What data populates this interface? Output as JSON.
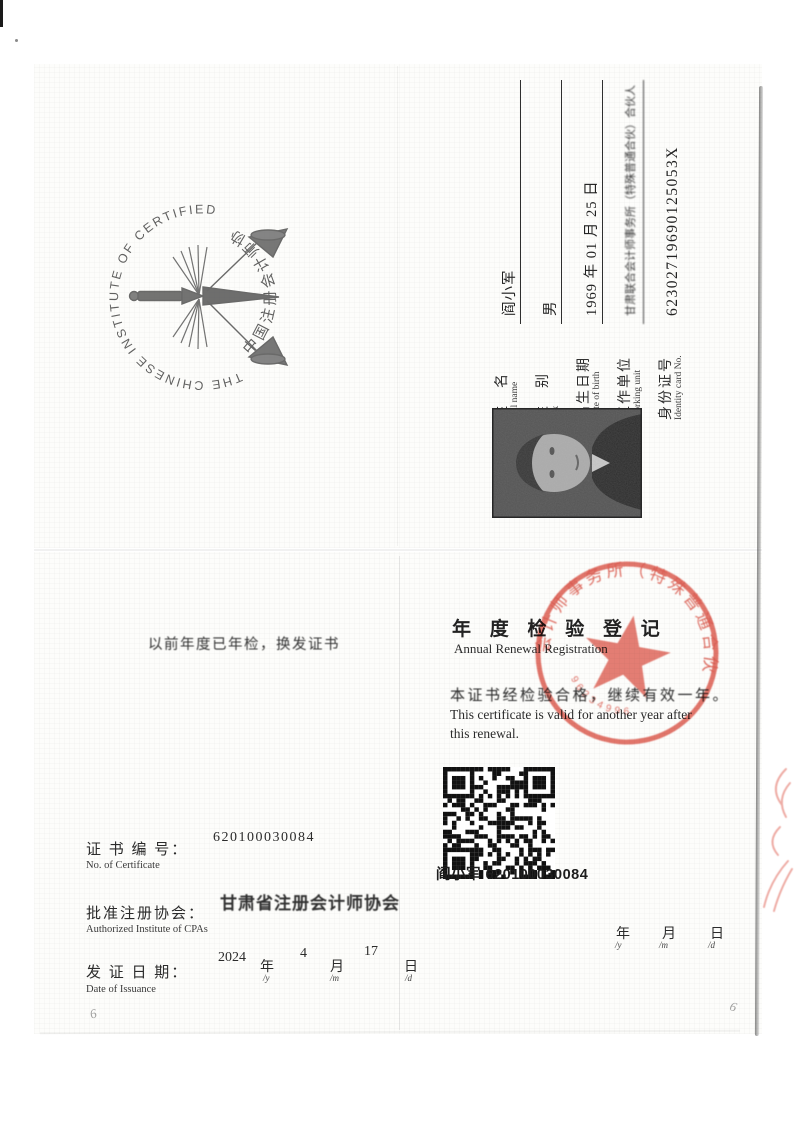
{
  "doc": {
    "kind": "CPA certificate scan"
  },
  "seal": {
    "ring_text_en": "THE CHINESE INSTITUTE OF CERTIFIED PUBLIC ACCOUNTANTS",
    "ring_text_cn": "中国注册会计师协会"
  },
  "info_page": {
    "fields": [
      {
        "label_cn": "姓　名",
        "label_en": "Full name",
        "value": "阎小军"
      },
      {
        "label_cn": "性　别",
        "label_en": "Sex",
        "value": "男"
      },
      {
        "label_cn": "出生日期",
        "label_en": "Date of birth",
        "value": "1969 年 01 月 25 日"
      },
      {
        "label_cn": "工作单位",
        "label_en": "Working unit",
        "value": "甘肃联合会计师事务所（特殊普通合伙）合伙人"
      },
      {
        "label_cn": "身份证号",
        "label_en": "Identity card No.",
        "value": "62302719690125053X"
      }
    ]
  },
  "renewal_page": {
    "left_note": "以前年度已年检，换发证书",
    "title_cn": "年 度 检 验 登 记",
    "title_en": "Annual Renewal Registration",
    "body_cn": "本证书经检验合格，继续有效一年。",
    "body_en_line1": "This certificate is valid for another year after",
    "body_en_line2": "this renewal.",
    "qr_caption": "阎小军  620100030084",
    "cert_no": {
      "label_cn": "证 书 编 号：",
      "label_en": "No. of Certificate",
      "value": "620100030084"
    },
    "institute": {
      "label_cn": "批准注册协会：",
      "label_en": "Authorized Institute of CPAs",
      "value": "甘肃省注册会计师协会"
    },
    "issuance": {
      "label_cn": "发 证 日 期：",
      "label_en": "Date of Issuance",
      "year": "2024",
      "year_unit": "年",
      "y_small": "/y",
      "month": "4",
      "month_unit": "月",
      "m_small": "/m",
      "day": "17",
      "day_unit": "日",
      "d_small": "/d"
    },
    "blank_date": {
      "year_unit": "年",
      "y_small": "/y",
      "month_unit": "月",
      "m_small": "/m",
      "day_unit": "日",
      "d_small": "/d"
    },
    "page_no_left": "6",
    "page_no_right": "6"
  },
  "stamp": {
    "arc_text": "会计师事务所（特殊普通合伙）",
    "digits": "96234996",
    "color": "#d9473a"
  },
  "colors": {
    "stamp_red": "#d9473a",
    "ink": "#2e2e2e",
    "paper": "#fdfdfb"
  }
}
